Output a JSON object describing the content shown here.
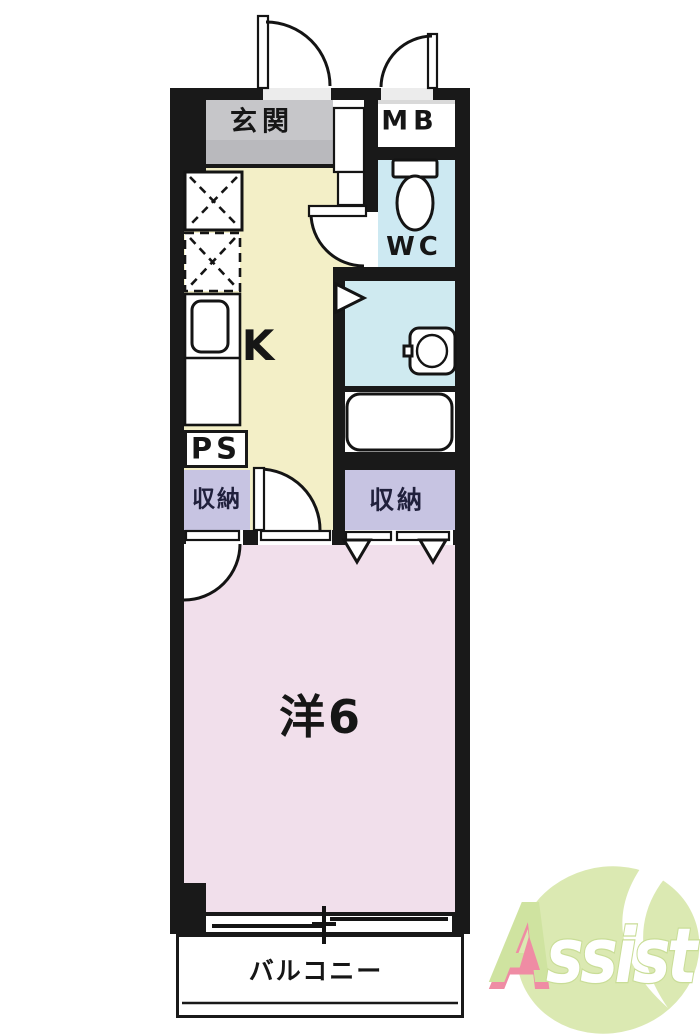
{
  "floor_plan": {
    "rooms": {
      "genkan_label": "玄関",
      "meter_box_label": "MB",
      "wc_label": "WC",
      "kitchen_label": "K",
      "pipe_space_label": "PS",
      "storage_left_label": "収納",
      "storage_right_label": "収納",
      "western_room_label": "洋6",
      "balcony_label": "バルコニー"
    },
    "colors": {
      "wall": "#191919",
      "genkan": "#c6c6c9",
      "kitchen": "#f3efc7",
      "wet_area": "#cde9f2",
      "storage": "#c7c4e2",
      "western_room": "#f1dfeb",
      "balcony": "#ffffff"
    }
  },
  "logo": {
    "brand": "Assist",
    "letter_a": "A",
    "letters_rest": "ssist",
    "leaf_color": "#dbe9b2",
    "text_color": "#ffffff",
    "accent_pink": "#ef8ca4"
  }
}
